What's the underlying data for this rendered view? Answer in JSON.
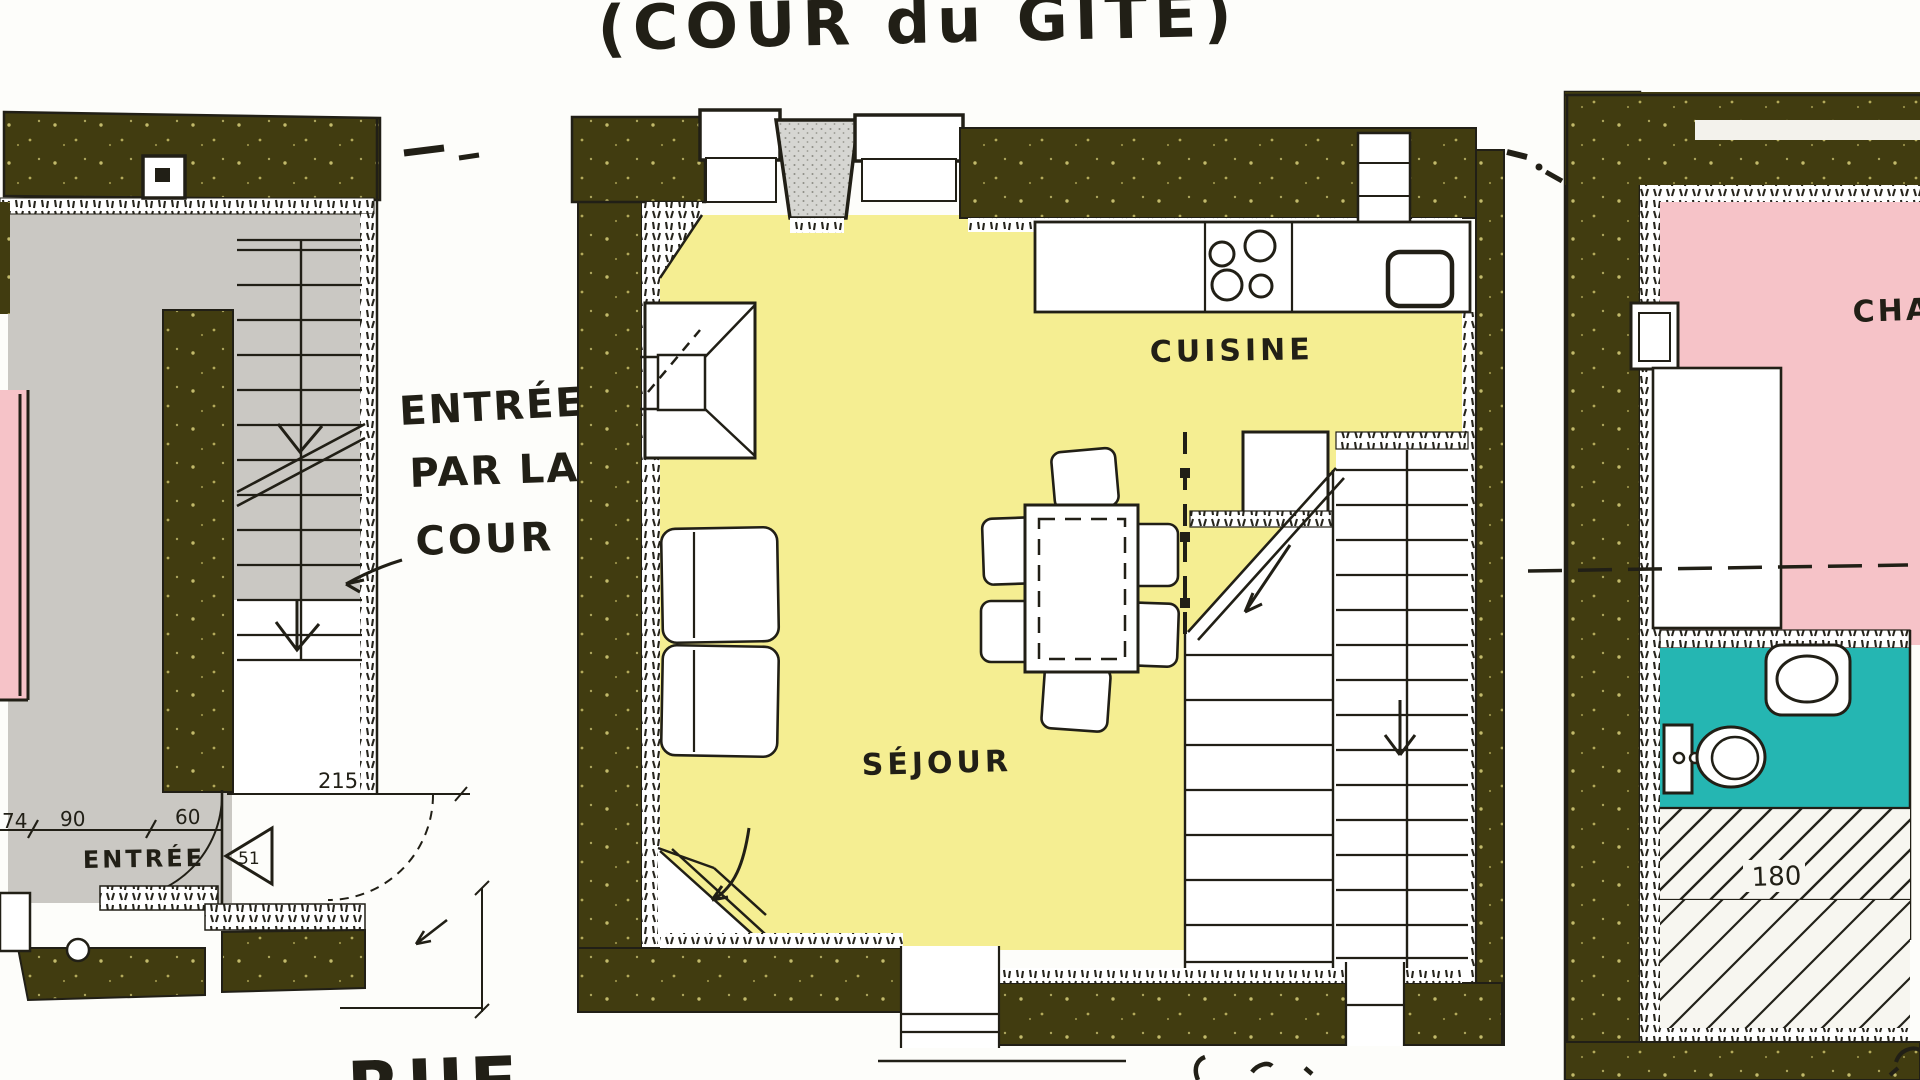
{
  "title": "(COUR du GÎTE)",
  "annotations": {
    "entry_note_line1": "ENTRÉE",
    "entry_note_line2": "PAR LA",
    "entry_note_line3": "COUR"
  },
  "left_plan": {
    "entrance_label": "ENTRÉE",
    "street_label": "RUE",
    "door_ref": "51",
    "dims": {
      "d74": "74",
      "d90": "90",
      "d60": "60",
      "d215": "215"
    }
  },
  "center_plan": {
    "kitchen_label": "CUISINE",
    "living_room_label": "SÉJOUR"
  },
  "right_plan": {
    "bedroom_label": "CHAMBRE",
    "under_stair_dim": "180"
  },
  "colors": {
    "wall_olive": "#413c10",
    "floor_gray": "#cac8c3",
    "room_yellow": "#f5ee92",
    "room_pink": "#f6c3c8",
    "bath_teal": "#25b6b2",
    "ink": "#211f16",
    "paper": "#fdfdfa"
  }
}
